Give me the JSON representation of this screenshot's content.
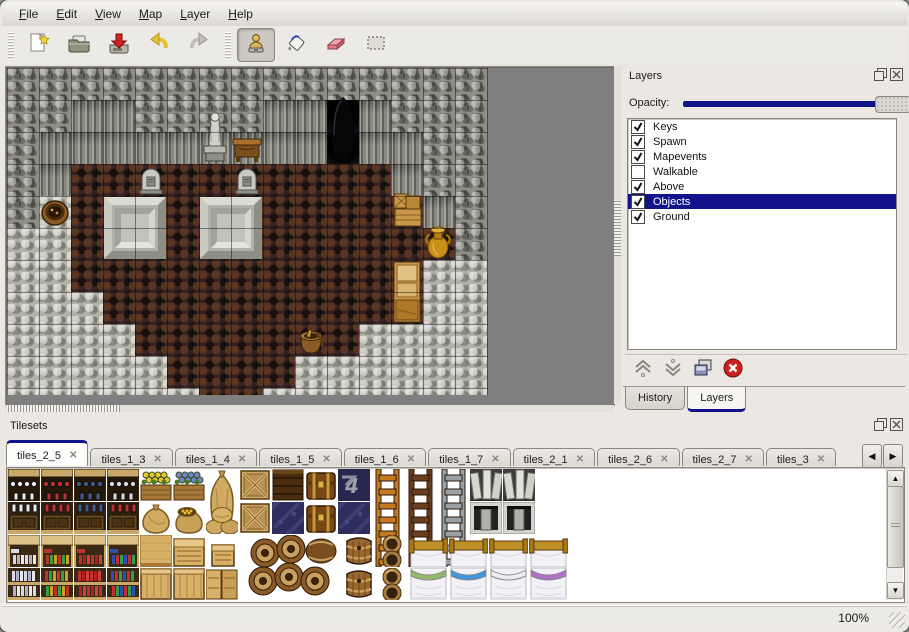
{
  "menubar": {
    "items": [
      {
        "label": "File"
      },
      {
        "label": "Edit"
      },
      {
        "label": "View"
      },
      {
        "label": "Map"
      },
      {
        "label": "Layer"
      },
      {
        "label": "Help"
      }
    ]
  },
  "toolbar": {
    "groups": [
      {
        "items": [
          {
            "icon": "new-file"
          },
          {
            "icon": "open-folder"
          },
          {
            "icon": "save"
          },
          {
            "icon": "undo"
          },
          {
            "icon": "redo"
          }
        ]
      },
      {
        "items": [
          {
            "icon": "stamp-tool",
            "pressed": true
          },
          {
            "icon": "fill-tool"
          },
          {
            "icon": "eraser-tool"
          },
          {
            "icon": "select-tool"
          }
        ]
      }
    ]
  },
  "layers_panel": {
    "title": "Layers",
    "opacity_label": "Opacity:",
    "items": [
      {
        "label": "Keys",
        "checked": true,
        "selected": false
      },
      {
        "label": "Spawn",
        "checked": true,
        "selected": false
      },
      {
        "label": "Mapevents",
        "checked": true,
        "selected": false
      },
      {
        "label": "Walkable",
        "checked": false,
        "selected": false
      },
      {
        "label": "Above",
        "checked": true,
        "selected": false
      },
      {
        "label": "Objects",
        "checked": true,
        "selected": true
      },
      {
        "label": "Ground",
        "checked": true,
        "selected": false
      }
    ],
    "tool_icons": [
      "raise-layer",
      "lower-layer",
      "duplicate-layer",
      "delete-layer"
    ],
    "tabs": [
      {
        "label": "History",
        "active": false
      },
      {
        "label": "Layers",
        "active": true
      }
    ]
  },
  "tilesets_panel": {
    "title": "Tilesets",
    "tabs": [
      {
        "label": "tiles_2_5",
        "active": true
      },
      {
        "label": "tiles_1_3",
        "active": false
      },
      {
        "label": "tiles_1_4",
        "active": false
      },
      {
        "label": "tiles_1_5",
        "active": false
      },
      {
        "label": "tiles_1_6",
        "active": false
      },
      {
        "label": "tiles_1_7",
        "active": false
      },
      {
        "label": "tiles_2_1",
        "active": false
      },
      {
        "label": "tiles_2_6",
        "active": false
      },
      {
        "label": "tiles_2_7",
        "active": false
      },
      {
        "label": "tiles_3",
        "active": false
      }
    ]
  },
  "statusbar": {
    "zoom": "100%"
  },
  "colors": {
    "accent": "#12128a",
    "selection": "#12128a",
    "canvas_bg": "#7f7f7f"
  },
  "map": {
    "tile_size": 32,
    "grid": [
      "WWWWWWWWWWWWWWW",
      "WWFFWWWWFFEFWWW",
      "WFFFFFFFFFEFFWW",
      "WFBBBBBBBBBBFWW",
      "WRBBBBBBBBBBBFW",
      "RRBBBBBBBBBBBBW",
      "RRBBBBBBBBBBBRR",
      "RRRBBBBBBBBBBRR",
      "RRRRBBBBBBBRRRR",
      "RRRRRBBBBRRRRRR",
      "RRRRRRBBRRRRRRR"
    ],
    "objects": [
      {
        "type": "statue",
        "x": 6,
        "y": 1,
        "w": 1,
        "h": 2
      },
      {
        "type": "desk",
        "x": 7,
        "y": 2,
        "w": 1,
        "h": 1
      },
      {
        "type": "entrance",
        "x": 10,
        "y": 0.85,
        "w": 1,
        "h": 2.15
      },
      {
        "type": "gravestone",
        "x": 4,
        "y": 3,
        "w": 1,
        "h": 1
      },
      {
        "type": "gravestone",
        "x": 7,
        "y": 3,
        "w": 1,
        "h": 1
      },
      {
        "type": "slab",
        "x": 3,
        "y": 4,
        "w": 2,
        "h": 2
      },
      {
        "type": "slab",
        "x": 6,
        "y": 4,
        "w": 2,
        "h": 2
      },
      {
        "type": "barrel-open",
        "x": 1,
        "y": 4,
        "w": 1,
        "h": 1
      },
      {
        "type": "crate-stack",
        "x": 12,
        "y": 3.85,
        "w": 1,
        "h": 1.15
      },
      {
        "type": "vase",
        "x": 12.9,
        "y": 4.85,
        "w": 1.1,
        "h": 1.15
      },
      {
        "type": "cabinet",
        "x": 12,
        "y": 6,
        "w": 1,
        "h": 2
      },
      {
        "type": "bucket",
        "x": 9,
        "y": 8,
        "w": 1,
        "h": 1
      }
    ]
  },
  "tileset_sprites": [
    {
      "t": "shelf_top",
      "x": 1,
      "y": 1,
      "c": "#e8e8f0"
    },
    {
      "t": "shelf_top",
      "x": 34,
      "y": 1,
      "c": "#c03030"
    },
    {
      "t": "shelf_top",
      "x": 67,
      "y": 1,
      "c": "#46598c"
    },
    {
      "t": "shelf_top",
      "x": 100,
      "y": 1,
      "c": "#dcdce8"
    },
    {
      "t": "flowerbox",
      "x": 133,
      "y": 1,
      "c": "#e8c832"
    },
    {
      "t": "flowerbox",
      "x": 166,
      "y": 1,
      "c": "#6f86c8"
    },
    {
      "t": "sack_big",
      "x": 199,
      "y": 1
    },
    {
      "t": "crate_x",
      "x": 232,
      "y": 1
    },
    {
      "t": "crate_dark",
      "x": 265,
      "y": 1
    },
    {
      "t": "chest",
      "x": 298,
      "y": 1
    },
    {
      "t": "logo4",
      "x": 331,
      "y": 1
    },
    {
      "t": "ladder",
      "x": 364,
      "y": 1,
      "c": "#c87820"
    },
    {
      "t": "ladder",
      "x": 397,
      "y": 1,
      "c": "#6a3c20"
    },
    {
      "t": "ladder",
      "x": 430,
      "y": 1,
      "c": "#9aa0a8"
    },
    {
      "t": "arch",
      "x": 463,
      "y": 1
    },
    {
      "t": "arch",
      "x": 496,
      "y": 1
    },
    {
      "t": "shelf_bot",
      "x": 1,
      "y": 34,
      "c": "#e8e8f0"
    },
    {
      "t": "shelf_bot",
      "x": 34,
      "y": 34,
      "c": "#c03030"
    },
    {
      "t": "shelf_bot",
      "x": 67,
      "y": 34,
      "c": "#46598c"
    },
    {
      "t": "shelf_bot",
      "x": 100,
      "y": 34,
      "c": "#c03030"
    },
    {
      "t": "sack",
      "x": 133,
      "y": 34
    },
    {
      "t": "sack_open",
      "x": 166,
      "y": 34
    },
    {
      "t": "sack_pile",
      "x": 199,
      "y": 34
    },
    {
      "t": "crate_x",
      "x": 232,
      "y": 34
    },
    {
      "t": "navy_tile",
      "x": 265,
      "y": 34
    },
    {
      "t": "chest",
      "x": 298,
      "y": 34
    },
    {
      "t": "navy_tile",
      "x": 331,
      "y": 34
    },
    {
      "t": "alcove",
      "x": 463,
      "y": 34
    },
    {
      "t": "alcove",
      "x": 496,
      "y": 34
    },
    {
      "t": "shelfL_top",
      "x": 1,
      "y": 67,
      "v": 0
    },
    {
      "t": "shelfL_top",
      "x": 34,
      "y": 67,
      "v": 1
    },
    {
      "t": "shelfL_top",
      "x": 67,
      "y": 67,
      "v": 2
    },
    {
      "t": "shelfL_top",
      "x": 100,
      "y": 67,
      "v": 3
    },
    {
      "t": "counter",
      "x": 133,
      "y": 67
    },
    {
      "t": "crate_lid",
      "x": 166,
      "y": 67
    },
    {
      "t": "crate_small",
      "x": 199,
      "y": 67
    },
    {
      "t": "barrels_pile",
      "x": 240,
      "y": 67,
      "w": 93,
      "h": 64
    },
    {
      "t": "barrel_up",
      "x": 336,
      "y": 67
    },
    {
      "t": "barrel_up",
      "x": 336,
      "y": 100
    },
    {
      "t": "pots",
      "x": 369,
      "y": 67
    },
    {
      "t": "pots",
      "x": 369,
      "y": 100
    },
    {
      "t": "bed_head",
      "x": 402,
      "y": 67,
      "w": 39
    },
    {
      "t": "bed_head",
      "x": 442,
      "y": 67,
      "w": 39
    },
    {
      "t": "bed_head",
      "x": 482,
      "y": 67,
      "w": 39
    },
    {
      "t": "bed_head",
      "x": 522,
      "y": 67,
      "w": 39
    },
    {
      "t": "bed_foot",
      "x": 402,
      "y": 100,
      "w": 39,
      "c": "#8fba68"
    },
    {
      "t": "bed_foot",
      "x": 442,
      "y": 100,
      "w": 39,
      "c": "#3f96d8"
    },
    {
      "t": "bed_foot",
      "x": 482,
      "y": 100,
      "w": 39,
      "c": "#ececf2"
    },
    {
      "t": "bed_foot",
      "x": 522,
      "y": 100,
      "w": 39,
      "c": "#b070c8"
    },
    {
      "t": "shelfL_bot",
      "x": 1,
      "y": 100,
      "v": 0
    },
    {
      "t": "shelfL_bot",
      "x": 34,
      "y": 100,
      "v": 1
    },
    {
      "t": "shelfL_bot",
      "x": 67,
      "y": 100,
      "v": 2
    },
    {
      "t": "shelfL_bot",
      "x": 100,
      "y": 100,
      "v": 3
    },
    {
      "t": "crate",
      "x": 133,
      "y": 100
    },
    {
      "t": "crate",
      "x": 166,
      "y": 100
    },
    {
      "t": "crate_double",
      "x": 199,
      "y": 100
    }
  ]
}
